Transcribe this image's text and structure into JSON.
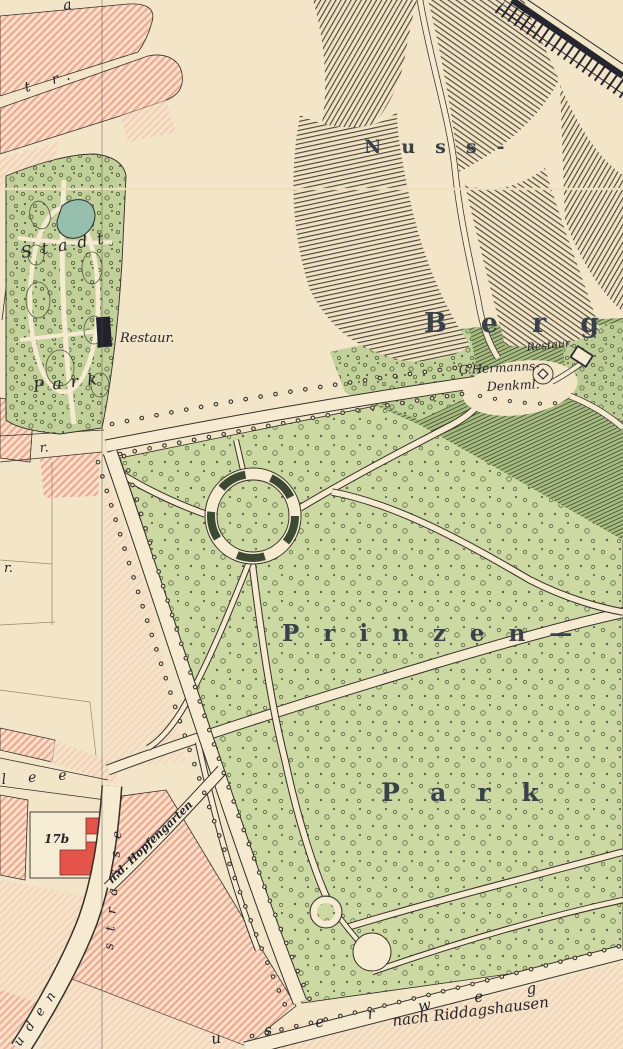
{
  "canvas": {
    "width": 623,
    "height": 1049
  },
  "palette": {
    "paper": "#f3e5c7",
    "road_cream": "#f6ead0",
    "park_green": "#ccd9a3",
    "slope_green": "#a9bd82",
    "pond_teal": "#96bfae",
    "block_pink": "#efa68e",
    "building_red": "#e4544b",
    "ink": "#2c2a2e",
    "label_color": "#39424c"
  },
  "labels": {
    "nussberg_word1": "Nuss-",
    "nussberg_word2": "Berg",
    "nussberg_restaurant": "Restaur.",
    "monument_line1": "G.Hermanns-",
    "monument_line2": "Denkml.",
    "stadtpark_word1": "Stadt",
    "stadtpark_word2": "Park",
    "stadtpark_restaurant": "Restaur.",
    "prinzenpark_word1": "Prinzen—",
    "prinzenpark_word2": "Park"
  },
  "streets": {
    "top_edge_cut": "a",
    "tr_street": "t r.",
    "r_street": "r.",
    "r_plot": "r.",
    "allee_end": "lee",
    "strasse_upper": "strasse",
    "strasse_lower": "uden",
    "hopfengarten_lane": "n.d. Hopfengarten",
    "riddagshaeuser_weg_letters": "userweg",
    "direction_note": "nach Riddagshausen"
  },
  "buildings": {
    "plot_number": "17b"
  }
}
